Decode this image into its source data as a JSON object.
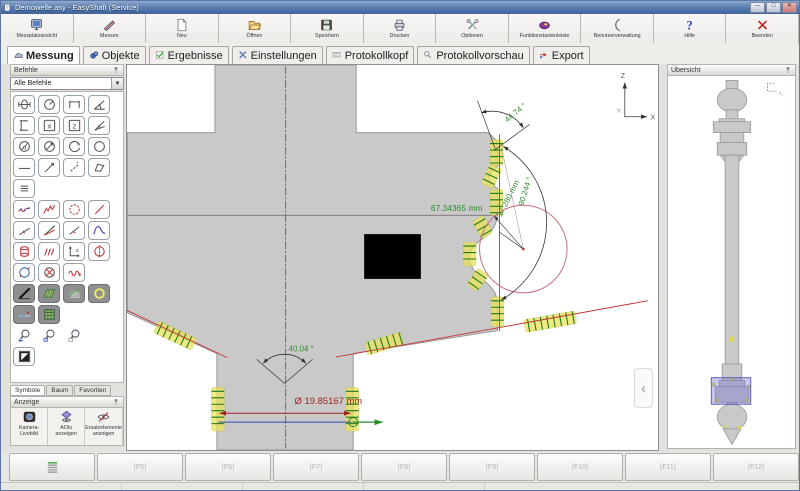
{
  "window": {
    "title": "Demowelle.asy - EasyShaft (Service)",
    "controls": [
      {
        "name": "minimize",
        "glyph": "─"
      },
      {
        "name": "maximize",
        "glyph": "□"
      },
      {
        "name": "close",
        "glyph": "✕"
      }
    ]
  },
  "toolbar": [
    {
      "label": "Messplatzansicht",
      "icon": "monitor-icon"
    },
    {
      "label": "Messen",
      "icon": "caliper-icon"
    },
    {
      "label": "Neu",
      "icon": "new-page-icon"
    },
    {
      "label": "Öffnen",
      "icon": "open-folder-icon"
    },
    {
      "label": "Speichern",
      "icon": "save-floppy-icon"
    },
    {
      "label": "Drucken",
      "icon": "printer-icon"
    },
    {
      "label": "Optionen",
      "icon": "tools-icon"
    },
    {
      "label": "Funktionstastenleiste",
      "icon": "fkeys-icon"
    },
    {
      "label": "Benutzerverwaltung",
      "icon": "user-admin-icon"
    },
    {
      "label": "Hilfe",
      "icon": "help-icon"
    },
    {
      "label": "Beenden",
      "icon": "exit-icon"
    }
  ],
  "tabs": [
    {
      "label": "Messung",
      "icon": "measure-tab-icon",
      "active": true
    },
    {
      "label": "Objekte",
      "icon": "objects-tab-icon",
      "active": false
    },
    {
      "label": "Ergebnisse",
      "icon": "results-tab-icon",
      "active": false
    },
    {
      "label": "Einstellungen",
      "icon": "settings-tab-icon",
      "active": false
    },
    {
      "label": "Protokollkopf",
      "icon": "protocol-header-tab-icon",
      "active": false
    },
    {
      "label": "Protokollvorschau",
      "icon": "protocol-preview-tab-icon",
      "active": false
    },
    {
      "label": "Export",
      "icon": "export-tab-icon",
      "active": false
    }
  ],
  "commands_panel": {
    "title": "Befehle",
    "filter_value": "Alle Befehle",
    "tool_rows": [
      [
        {
          "icon": "symmetry-icon"
        },
        {
          "icon": "radius-icon"
        },
        {
          "icon": "width-icon"
        },
        {
          "icon": "angle3-icon"
        }
      ],
      [
        {
          "icon": "height-icon"
        },
        {
          "icon": "posx-icon"
        },
        {
          "icon": "posz-icon"
        },
        {
          "icon": "angle2-icon"
        }
      ],
      [
        {
          "icon": "circle-d-icon"
        },
        {
          "icon": "circle-diam-icon"
        },
        {
          "icon": "circle-arc-icon"
        },
        {
          "icon": "circle-icon"
        }
      ],
      [
        {
          "icon": "hline-icon"
        },
        {
          "icon": "dirline-icon"
        },
        {
          "icon": "dashline-icon"
        },
        {
          "icon": "quad-icon"
        }
      ],
      [
        {
          "icon": "parallel-icon"
        }
      ],
      [
        {
          "icon": "spline-icon"
        },
        {
          "icon": "profile-icon"
        },
        {
          "icon": "scatter-circle-icon"
        },
        {
          "icon": "fitline-icon"
        }
      ],
      [
        {
          "icon": "perpline-icon"
        },
        {
          "icon": "anglelines-icon"
        },
        {
          "icon": "midline-icon"
        },
        {
          "icon": "peak-icon"
        }
      ],
      [
        {
          "icon": "cylinder-icon"
        },
        {
          "icon": "grooves-icon"
        },
        {
          "icon": "coordz-icon"
        },
        {
          "icon": "runout-icon"
        }
      ],
      [
        {
          "icon": "formcircle-icon"
        },
        {
          "icon": "crosscircle-icon"
        },
        {
          "icon": "wave-icon"
        }
      ],
      [
        {
          "icon": "blackdiag-icon",
          "style": "dark"
        },
        {
          "icon": "hatch-icon",
          "style": "dark"
        },
        {
          "icon": "arcseg-icon",
          "style": "dark"
        },
        {
          "icon": "ring-icon",
          "style": "dark"
        }
      ],
      [
        {
          "icon": "eval-icon",
          "style": "dark"
        },
        {
          "icon": "table-icon",
          "style": "dark"
        }
      ],
      [
        {
          "icon": "zoomback-icon",
          "style": "flat"
        },
        {
          "icon": "zoomwin-icon",
          "style": "flat"
        },
        {
          "icon": "zoomfit-icon",
          "style": "flat"
        }
      ],
      [
        {
          "icon": "contrast-icon"
        }
      ]
    ],
    "tabs": [
      "Symbole",
      "Baum",
      "Favoriten"
    ],
    "active_tab": "Symbole"
  },
  "display_panel": {
    "title": "Anzeige",
    "buttons": [
      {
        "label": [
          "Kamera-",
          "Livebild"
        ],
        "icon": "camera-icon"
      },
      {
        "label": [
          "AOIs",
          "anzeigen"
        ],
        "icon": "aoi-eye-icon"
      },
      {
        "label": [
          "Ersatzelemente",
          "anzeigen"
        ],
        "icon": "hidden-eye-icon"
      }
    ]
  },
  "canvas": {
    "measurements": {
      "width": "67.34365 mm",
      "angle_top": "44.74 °",
      "angle_arc": "90.244 °",
      "length_diag": "17.280 mm",
      "cone_angle": "40.04 °",
      "diameter": "Ø 19.85167 mm"
    },
    "axis_labels": {
      "up": "Z",
      "right": "X",
      "origin": "Y"
    },
    "colors": {
      "dimension_green": "#2f8b2f",
      "dimension_red": "#a22222",
      "fit_red": "#c23333",
      "probe_yellow": "#e8e15a",
      "probe_green": "#1e7a1e",
      "circle_red": "#c4717f",
      "shaft_gray": "#c9c9c9"
    }
  },
  "overview_panel": {
    "title": "Übersicht"
  },
  "function_bar": [
    {
      "label": "",
      "icon": "layers-icon"
    },
    {
      "label": "(F5)"
    },
    {
      "label": "(F6)"
    },
    {
      "label": "(F7)"
    },
    {
      "label": "(F8)"
    },
    {
      "label": "(F9)"
    },
    {
      "label": "(F10)"
    },
    {
      "label": "(F11)"
    },
    {
      "label": "(F12)"
    }
  ]
}
